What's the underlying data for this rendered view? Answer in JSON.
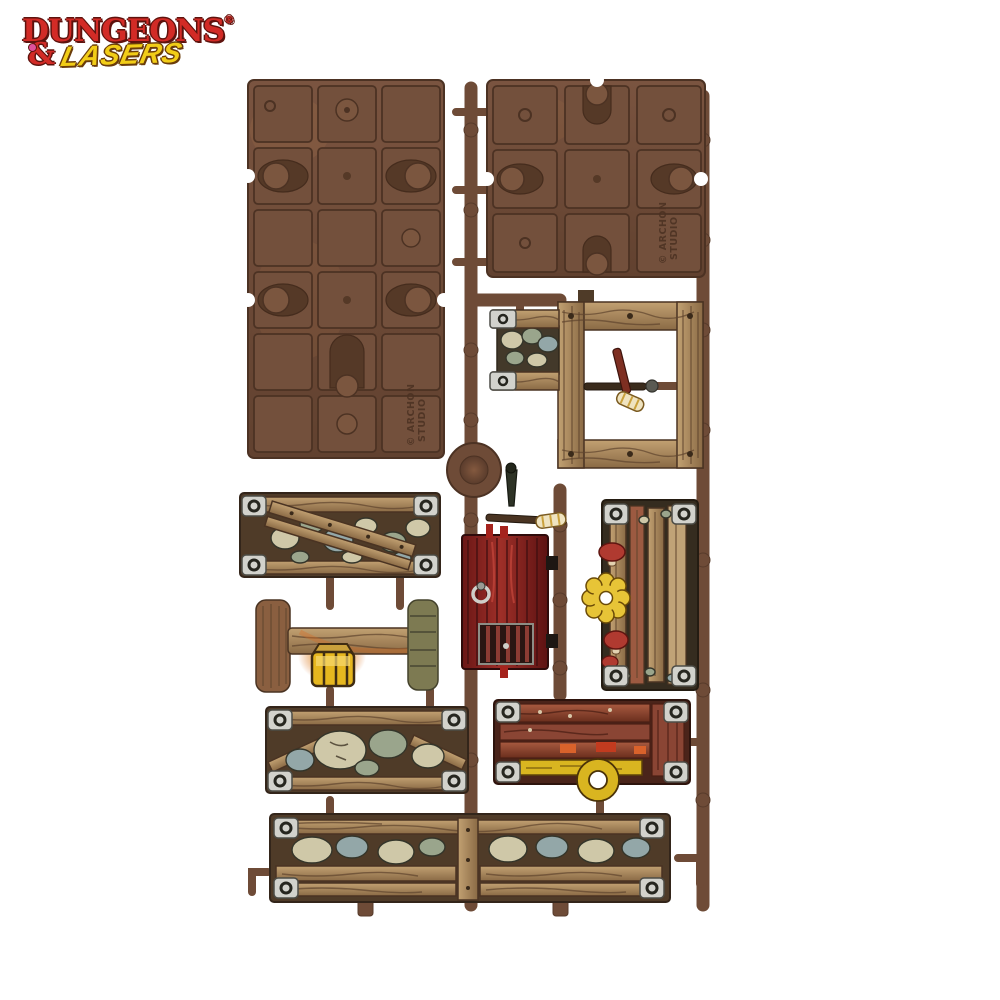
{
  "page": {
    "description": "Product photo on white background: a brown plastic model sprue (Dungeons and Lasers terrain frame) holding two unpainted floor-tile panels and several hand-painted dungeon pieces - stone-and-wood wall sections, a wooden door frame with torch, a red wooden door, a lantern on a beam, a mushroom-covered wall and a long wall section"
  },
  "logo": {
    "word1": "DUNGEONS",
    "registered_mark": "®",
    "ampersand": "&",
    "word2": "LASERS"
  },
  "sprue": {
    "mold_line1": "© ARCHON",
    "mold_line2": "STUDIO"
  },
  "colors": {
    "c-bg": "#ffffff",
    "c-logo-red": "#d22b26",
    "c-logo-yellow": "#f2cd17",
    "c-gem-pink": "#e0519c",
    "c-sprue": "#6e4b37",
    "c-sprue-dark": "#553a2b",
    "c-panel-light": "#7d5742",
    "c-tile": "#73503c",
    "c-pocket": "#553927",
    "c-wood": "#ac8a5e",
    "c-stone-cream": "#cfc8a8",
    "c-stone-green": "#9aa58c",
    "c-stone-blue": "#93a7a8",
    "c-metal": "#d2d2cc",
    "c-door-red": "#7c2022",
    "c-lantern-yellow": "#e6b71f",
    "c-glow-orange": "#d96b1f",
    "c-mushroom-yellow": "#e7c437",
    "c-mushroom-red": "#b03a30",
    "c-plank-red": "#a0523b",
    "c-ring-yellow": "#d9b520"
  }
}
